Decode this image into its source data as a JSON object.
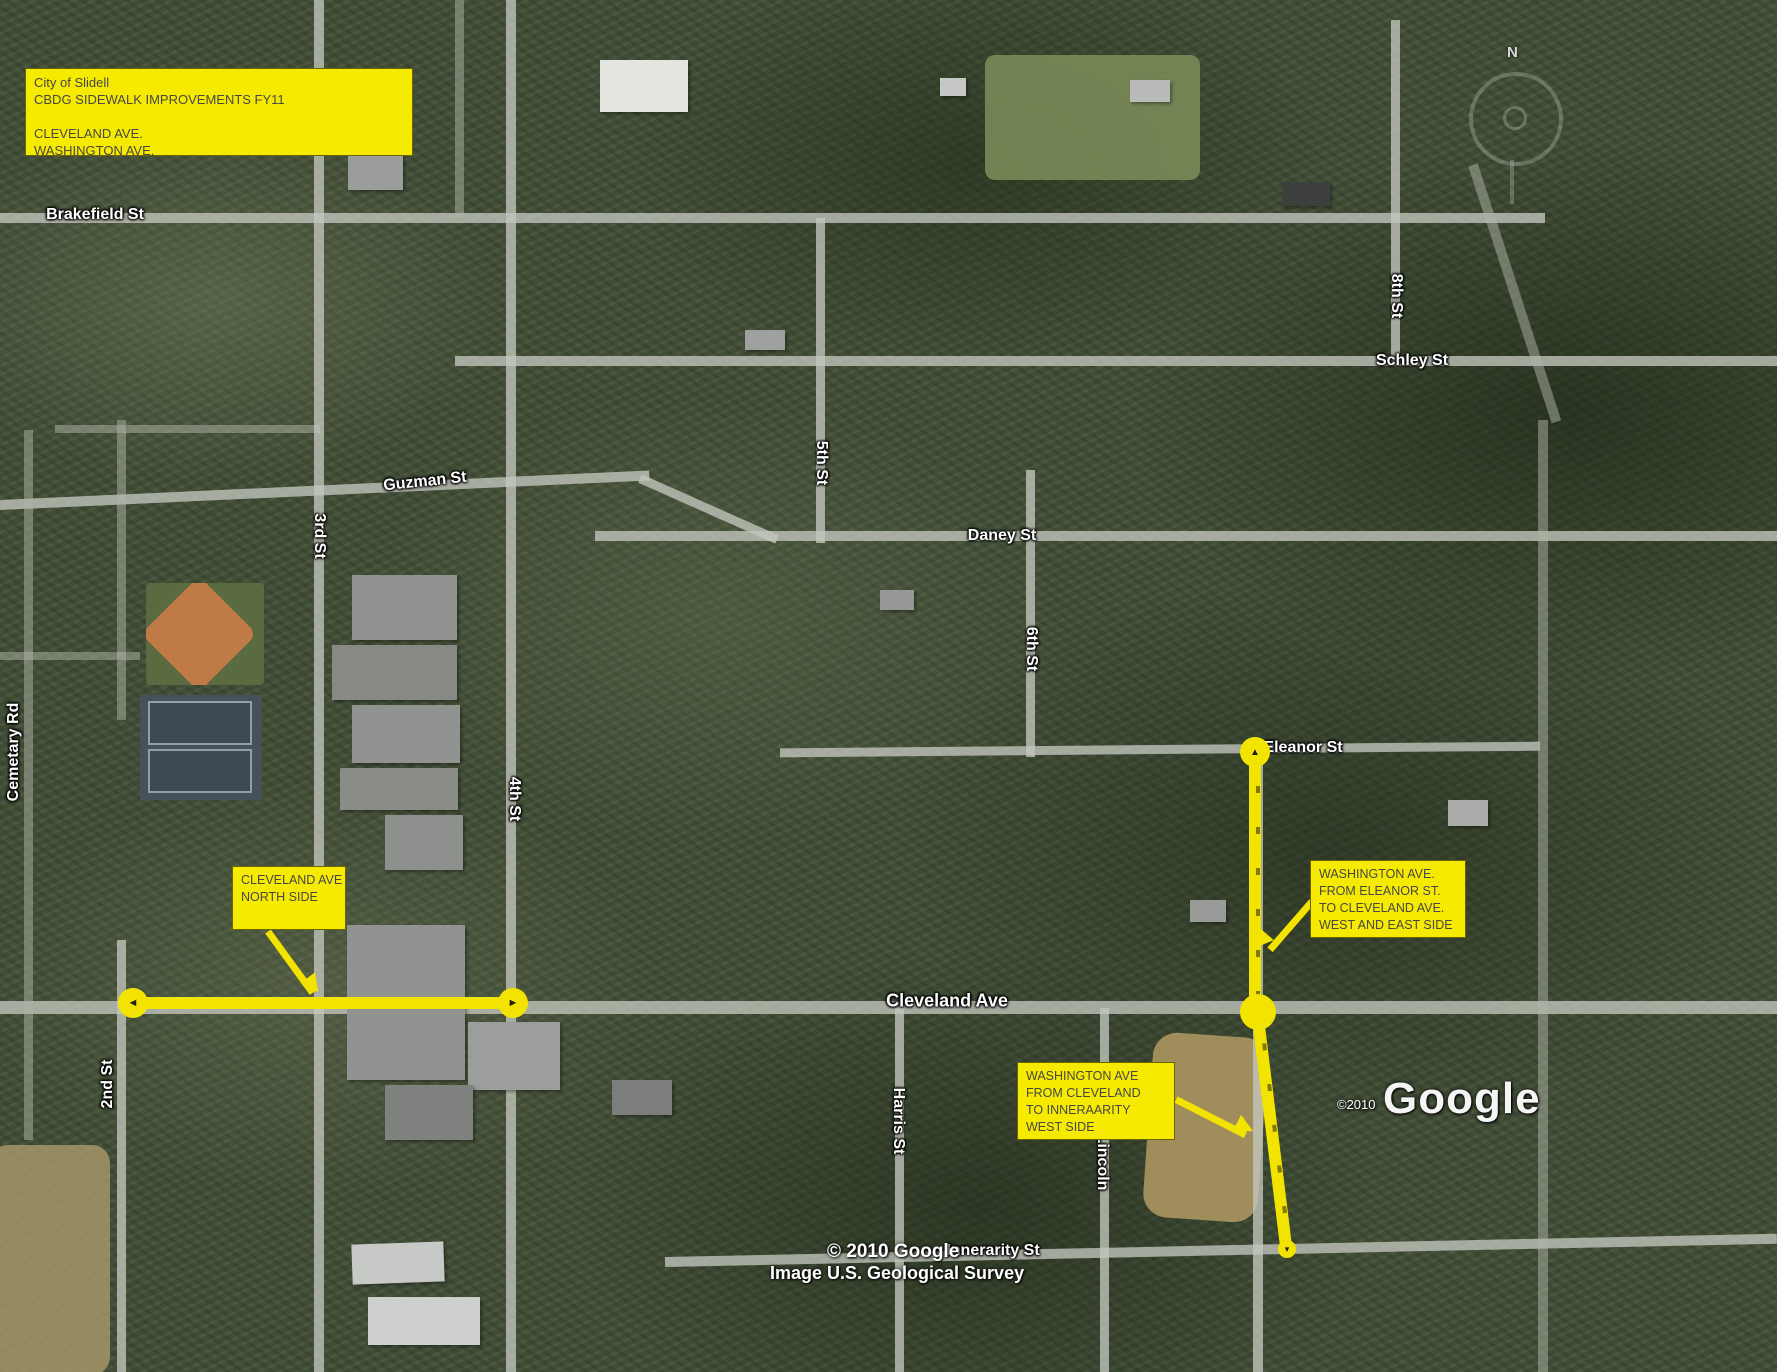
{
  "title_box": {
    "lines": [
      "City of Slidell",
      "CBDG SIDEWALK IMPROVEMENTS FY11",
      "",
      "CLEVELAND AVE.",
      "WASHINGTON AVE."
    ]
  },
  "callouts": [
    {
      "name": "cleveland-ave-north-side",
      "lines": [
        "CLEVELAND AVE",
        "NORTH SIDE"
      ]
    },
    {
      "name": "washington-eleanor-to-cleveland",
      "lines": [
        "WASHINGTON AVE.",
        "FROM ELEANOR ST.",
        "TO CLEVELAND AVE.",
        "WEST AND EAST SIDE"
      ]
    },
    {
      "name": "washington-cleveland-to-innerarity",
      "lines": [
        "WASHINGTON AVE",
        "FROM CLEVELAND",
        "TO INNERAARITY",
        "WEST SIDE"
      ]
    }
  ],
  "streets": [
    {
      "name": "Brakefield St"
    },
    {
      "name": "Schley St"
    },
    {
      "name": "Guzman St"
    },
    {
      "name": "Daney St"
    },
    {
      "name": "Eleanor St"
    },
    {
      "name": "Cleveland Ave"
    },
    {
      "name": "Innerarity St"
    },
    {
      "name": "2nd St"
    },
    {
      "name": "3rd St"
    },
    {
      "name": "4th St"
    },
    {
      "name": "5th St"
    },
    {
      "name": "6th St"
    },
    {
      "name": "8th St"
    },
    {
      "name": "Harris St"
    },
    {
      "name": "Lincoln"
    },
    {
      "name": "Cemetary Rd"
    }
  ],
  "attribution": {
    "center_copyright": "© 2010 Google",
    "survey": "Image U.S. Geological Survey",
    "corner_copyright": "©2010",
    "logo": "Google"
  },
  "compass": {
    "north": "N"
  },
  "icons": {
    "arrow_left": "◄",
    "arrow_right": "►",
    "arrow_up": "▲",
    "arrow_down": "▾"
  },
  "colors": {
    "highlight_yellow": "#f2e400",
    "box_yellow": "#f6ea00",
    "box_border": "#6b6400",
    "box_text": "#474747"
  }
}
